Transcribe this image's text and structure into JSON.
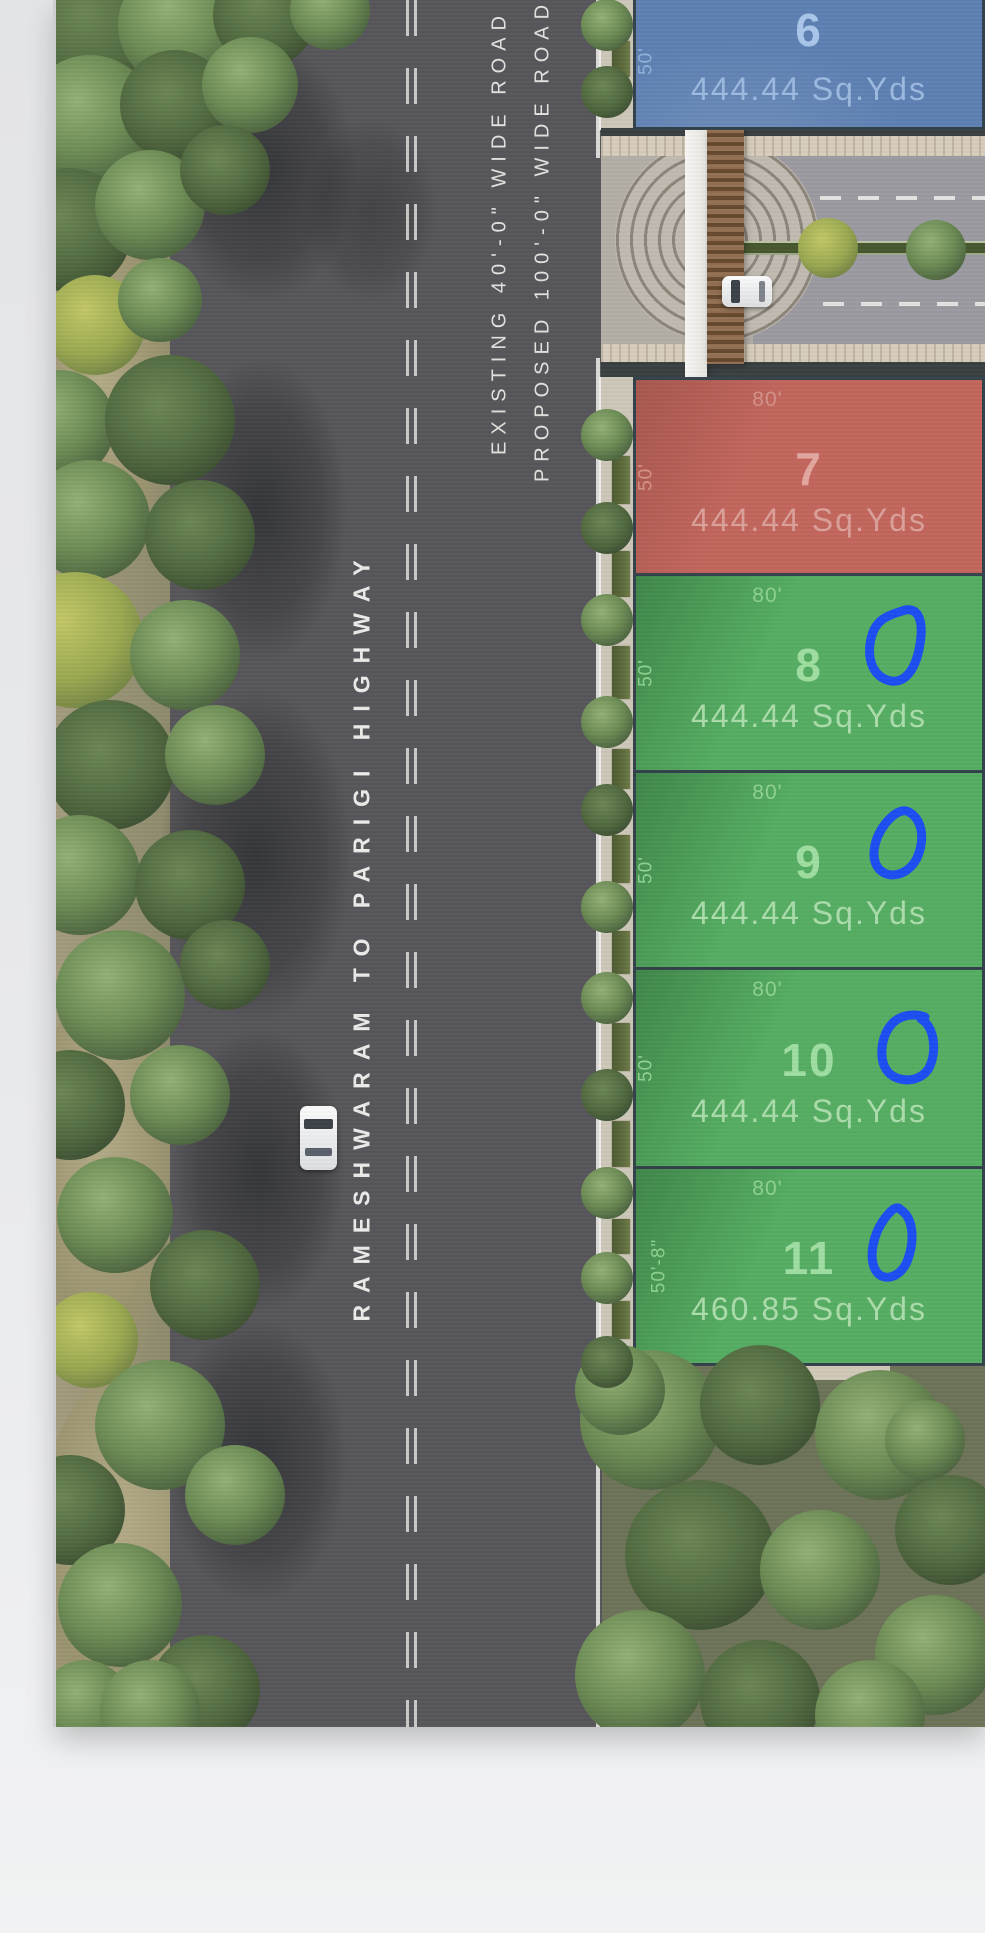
{
  "map": {
    "highway_label": "RAMESHWARAM TO PARIGI HIGHWAY",
    "road_labels": [
      "EXISTING 40'-0\" WIDE ROAD",
      "PROPOSED 100'-0\" WIDE ROAD"
    ],
    "plots": [
      {
        "number": "6",
        "width_label": "",
        "side_label": "50'",
        "area": "444.44 Sq.Yds",
        "fill": "#5d80b2",
        "marked": false
      },
      {
        "number": "7",
        "width_label": "80'",
        "side_label": "50'",
        "area": "444.44 Sq.Yds",
        "fill": "#c2665d",
        "marked": false
      },
      {
        "number": "8",
        "width_label": "80'",
        "side_label": "50'",
        "area": "444.44 Sq.Yds",
        "fill": "#55ad62",
        "marked": true
      },
      {
        "number": "9",
        "width_label": "80'",
        "side_label": "50'",
        "area": "444.44 Sq.Yds",
        "fill": "#55ad62",
        "marked": true
      },
      {
        "number": "10",
        "width_label": "80'",
        "side_label": "50'",
        "area": "444.44 Sq.Yds",
        "fill": "#55ad62",
        "marked": true
      },
      {
        "number": "11",
        "width_label": "80'",
        "side_label": "50'-8\"",
        "area": "460.85 Sq.Yds",
        "fill": "#55ad62",
        "marked": true
      }
    ],
    "annotation": {
      "pen_color": "#1d4ef0",
      "marked_plots": [
        "8",
        "9",
        "10",
        "11"
      ]
    }
  }
}
